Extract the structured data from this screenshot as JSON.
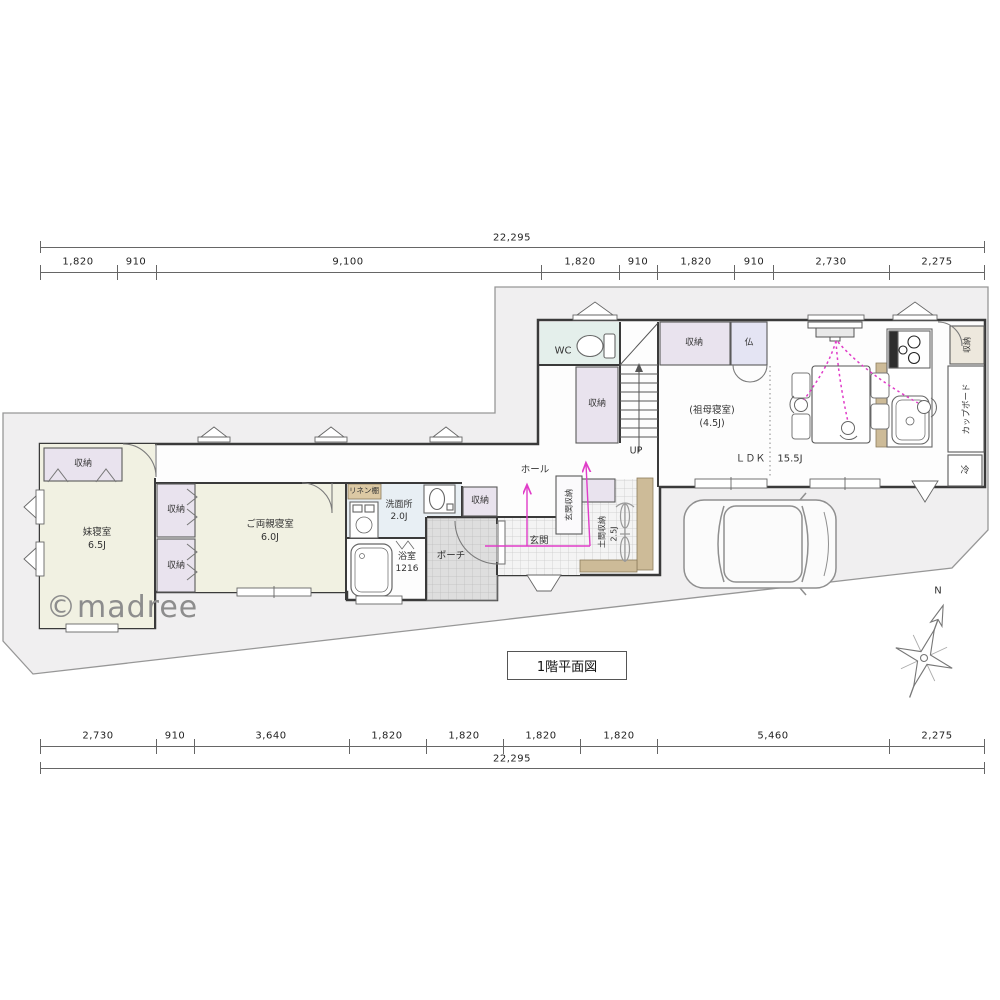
{
  "title": "1階平面図",
  "watermark": "©madree",
  "compass": {
    "north": "N"
  },
  "dimensions": {
    "total": "22,295",
    "top_segments": [
      "1,820",
      "910",
      "9,100",
      "1,820",
      "910",
      "1,820",
      "910",
      "2,730",
      "2,275"
    ],
    "bottom_segments": [
      "2,730",
      "910",
      "3,640",
      "1,820",
      "1,820",
      "1,820",
      "1,820",
      "5,460",
      "2,275"
    ]
  },
  "rooms": {
    "sister_bedroom": {
      "name": "妹寝室",
      "size": "6.5J"
    },
    "parents_bedroom": {
      "name": "ご両親寝室",
      "size": "6.0J"
    },
    "grandmother_bedroom": {
      "name": "(祖母寝室)",
      "size": "(4.5J)"
    },
    "ldk": {
      "name": "ＬＤＫ",
      "size": "15.5J"
    },
    "washroom": {
      "name": "洗面所",
      "size": "2.0J"
    },
    "bathroom": {
      "name": "浴室",
      "size": "1216"
    },
    "doma_storage": {
      "name": "土間収納",
      "size": "2.5J"
    },
    "wc": "WC",
    "hall": "ホール",
    "genkan": "玄関",
    "porch": "ポーチ",
    "linen_closet": "リネン棚",
    "genkan_storage": "玄関収納",
    "storage": "収納",
    "butsudan": "仏",
    "cupboard": "カップボード",
    "refrigerator": "冷",
    "stairs_up": "UP"
  },
  "colors": {
    "accent_pink": "#e03cc8",
    "plot_fill": "#f0eff0",
    "tatami": "#f1f1e2",
    "closet": "#e9e3ee",
    "wc": "#e4efeb",
    "washroom": "#e8eff4",
    "butsudan": "#e4e4f3",
    "wood": "#cdbb98"
  }
}
